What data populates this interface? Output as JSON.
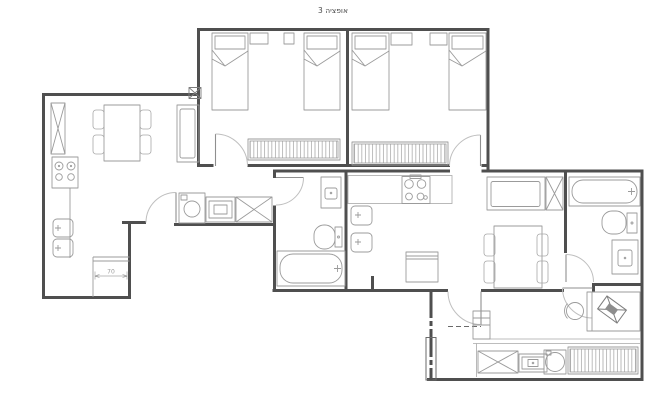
{
  "title": "אופציה 3",
  "dimension": {
    "value": "70"
  },
  "colors": {
    "wall": "#4f4f4f",
    "fixture_line": "#9b9b9b",
    "door_arc": "#bfbfbf",
    "background": "#ffffff",
    "title_text": "#4a4a4a",
    "dimension_text": "#9a9a9a"
  },
  "drawing": {
    "type": "apartment-floor-plan",
    "rooms": [
      {
        "name": "bedroom-1",
        "fixtures": [
          "single-bed",
          "single-bed",
          "nightstand",
          "nightstand",
          "wardrobe",
          "door"
        ]
      },
      {
        "name": "bedroom-2",
        "fixtures": [
          "single-bed",
          "single-bed",
          "nightstand",
          "nightstand",
          "wardrobe",
          "door"
        ]
      },
      {
        "name": "kitchen-dining-left",
        "fixtures": [
          "tall-cabinet",
          "stove",
          "counter",
          "double-sink",
          "dining-table",
          "chairs",
          "sofa"
        ]
      },
      {
        "name": "laundry-corridor",
        "fixtures": [
          "washing-machine",
          "dryer",
          "cabinet",
          "door"
        ]
      },
      {
        "name": "bathroom-1",
        "fixtures": [
          "vanity-sink",
          "toilet",
          "bathtub",
          "door"
        ]
      },
      {
        "name": "kitchen-2",
        "fixtures": [
          "stove",
          "counter",
          "sink",
          "sink",
          "counter-block"
        ]
      },
      {
        "name": "dining-living-right",
        "fixtures": [
          "sofa",
          "cabinet",
          "dining-table",
          "chairs"
        ]
      },
      {
        "name": "bathroom-2",
        "fixtures": [
          "bathtub",
          "toilet",
          "vanity-sink",
          "door"
        ]
      },
      {
        "name": "bedroom-3",
        "fixtures": [
          "desk",
          "office-chair",
          "wardrobe",
          "cabinet",
          "drawer-unit",
          "washing-machine",
          "door"
        ]
      }
    ]
  }
}
